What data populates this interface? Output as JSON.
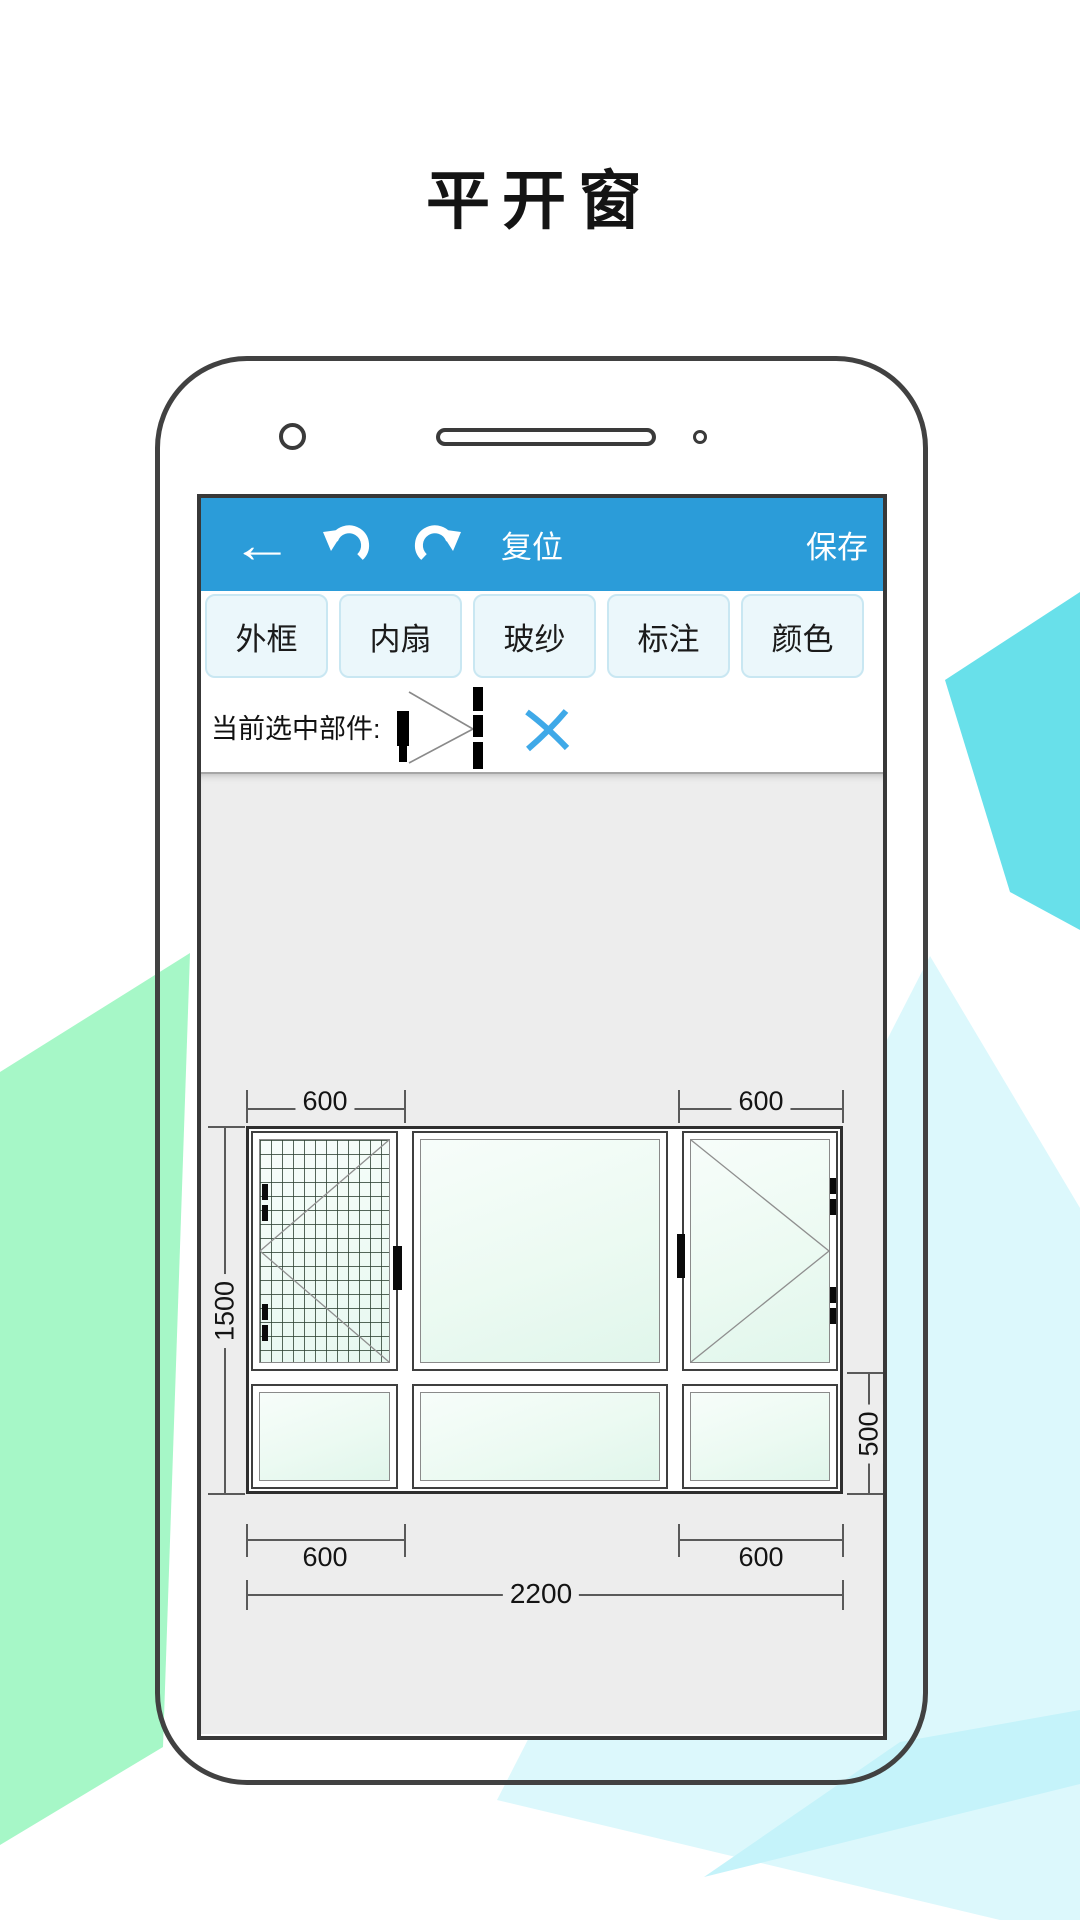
{
  "title": "平开窗",
  "toolbar": {
    "back_icon": "back-arrow",
    "undo_icon": "undo-arrow",
    "redo_icon": "redo-arrow",
    "reset_label": "复位",
    "save_label": "保存"
  },
  "tabs": [
    {
      "label": "外框"
    },
    {
      "label": "内扇"
    },
    {
      "label": "玻纱"
    },
    {
      "label": "标注"
    },
    {
      "label": "颜色"
    }
  ],
  "selection": {
    "label": "当前选中部件:",
    "icon": "sash-profile-icon",
    "clear_icon": "blue-x-icon"
  },
  "drawing": {
    "dim_top_left": "600",
    "dim_top_right": "600",
    "dim_left": "1500",
    "dim_right": "500",
    "dim_bottom_left": "600",
    "dim_bottom_right": "600",
    "dim_total_width": "2200"
  },
  "colors": {
    "toolbar_blue": "#2B9CD9",
    "tab_fill": "#EBF7FB",
    "tab_border": "#C9E7F2",
    "canvas_gray": "#EDEDED",
    "accent_x_blue": "#3FA9E8",
    "deco_green": "#A6F7C7",
    "deco_teal": "#68E0EA",
    "deco_cyan_light": "#DCF8FC",
    "deco_cyan_mid": "#C5F3FA"
  }
}
